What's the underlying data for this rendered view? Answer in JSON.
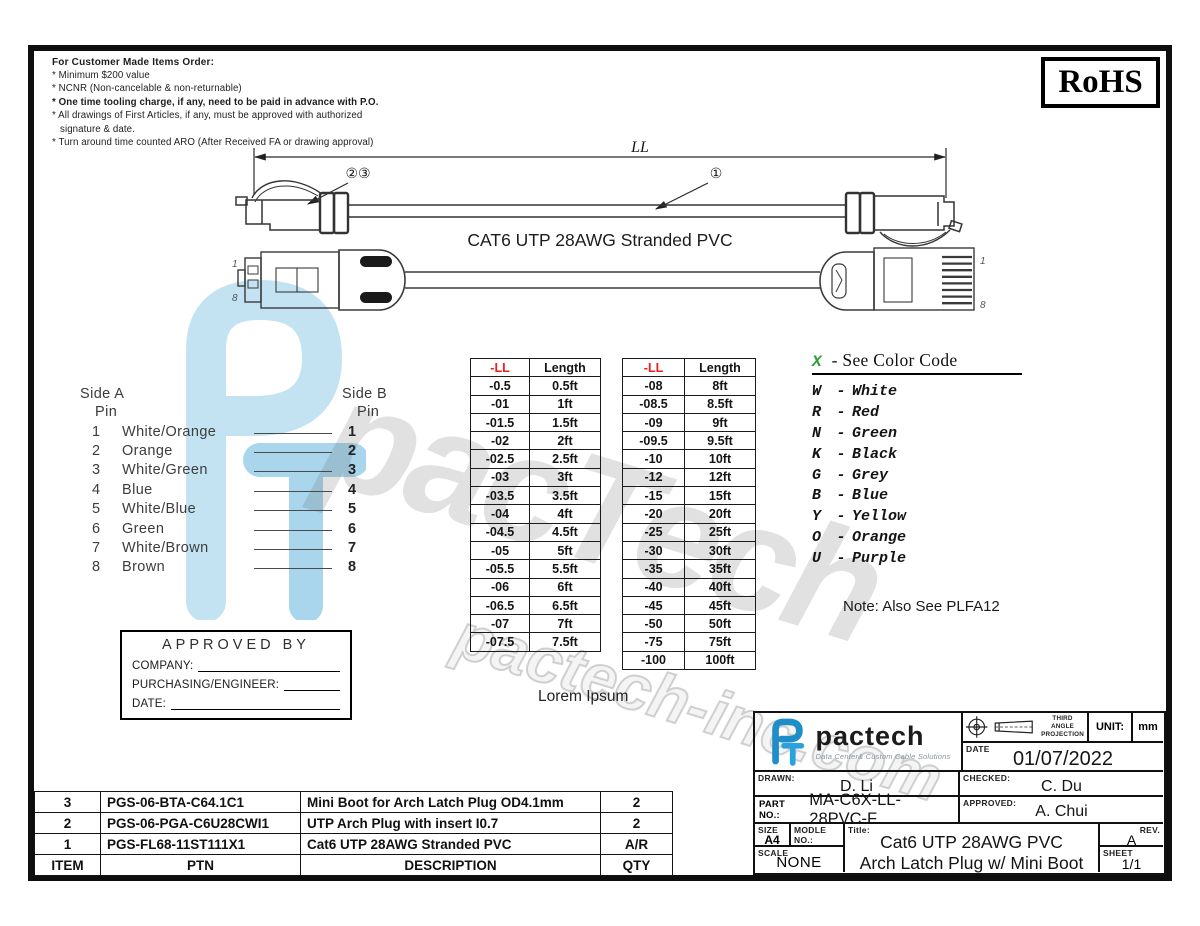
{
  "colors": {
    "accent_blue": "#2094d4",
    "red": "#e8201f",
    "green": "#2e9e3a"
  },
  "notes": {
    "title": "For Customer Made Items Order:",
    "lines": [
      "* Minimum $200 value",
      "* NCNR (Non-cancelable & non-returnable)",
      "* One time tooling charge, if any, need to be paid in advance with P.O.",
      "* All drawings of First Articles, if any, must be approved with authorized signature & date.",
      "* Turn around time counted ARO (After Received FA or drawing approval)"
    ]
  },
  "rohs_label": "RoHS",
  "drawing": {
    "dim_label": "LL",
    "callout_left": "②③",
    "callout_right": "①",
    "cable_label": "CAT6 UTP 28AWG Stranded PVC",
    "pin_first": "1",
    "pin_last": "8"
  },
  "wiring": {
    "side_a_title": "Side  A",
    "side_b_title": "Side  B",
    "pin_label": "Pin",
    "rows": [
      {
        "a": "1",
        "color": "White/Orange",
        "b": "1"
      },
      {
        "a": "2",
        "color": "Orange",
        "b": "2"
      },
      {
        "a": "3",
        "color": "White/Green",
        "b": "3"
      },
      {
        "a": "4",
        "color": "Blue",
        "b": "4"
      },
      {
        "a": "5",
        "color": "White/Blue",
        "b": "5"
      },
      {
        "a": "6",
        "color": "Green",
        "b": "6"
      },
      {
        "a": "7",
        "color": "White/Brown",
        "b": "7"
      },
      {
        "a": "8",
        "color": "Brown",
        "b": "8"
      }
    ]
  },
  "length_tables": [
    {
      "headers": [
        "-LL",
        "Length"
      ],
      "rows": [
        [
          "-0.5",
          "0.5ft"
        ],
        [
          "-01",
          "1ft"
        ],
        [
          "-01.5",
          "1.5ft"
        ],
        [
          "-02",
          "2ft"
        ],
        [
          "-02.5",
          "2.5ft"
        ],
        [
          "-03",
          "3ft"
        ],
        [
          "-03.5",
          "3.5ft"
        ],
        [
          "-04",
          "4ft"
        ],
        [
          "-04.5",
          "4.5ft"
        ],
        [
          "-05",
          "5ft"
        ],
        [
          "-05.5",
          "5.5ft"
        ],
        [
          "-06",
          "6ft"
        ],
        [
          "-06.5",
          "6.5ft"
        ],
        [
          "-07",
          "7ft"
        ],
        [
          "-07.5",
          "7.5ft"
        ]
      ]
    },
    {
      "headers": [
        "-LL",
        "Length"
      ],
      "rows": [
        [
          "-08",
          "8ft"
        ],
        [
          "-08.5",
          "8.5ft"
        ],
        [
          "-09",
          "9ft"
        ],
        [
          "-09.5",
          "9.5ft"
        ],
        [
          "-10",
          "10ft"
        ],
        [
          "-12",
          "12ft"
        ],
        [
          "-15",
          "15ft"
        ],
        [
          "-20",
          "20ft"
        ],
        [
          "-25",
          "25ft"
        ],
        [
          "-30",
          "30ft"
        ],
        [
          "-35",
          "35ft"
        ],
        [
          "-40",
          "40ft"
        ],
        [
          "-45",
          "45ft"
        ],
        [
          "-50",
          "50ft"
        ],
        [
          "-75",
          "75ft"
        ],
        [
          "-100",
          "100ft"
        ]
      ]
    }
  ],
  "color_code": {
    "header_x": "X",
    "header_rest": "-  See Color Code",
    "dash": "-",
    "entries": [
      {
        "letter": "W",
        "name": "White"
      },
      {
        "letter": "R",
        "name": "Red"
      },
      {
        "letter": "N",
        "name": "Green"
      },
      {
        "letter": "K",
        "name": "Black"
      },
      {
        "letter": "G",
        "name": "Grey"
      },
      {
        "letter": "B",
        "name": "Blue"
      },
      {
        "letter": "Y",
        "name": "Yellow"
      },
      {
        "letter": "O",
        "name": "Orange"
      },
      {
        "letter": "U",
        "name": "Purple"
      }
    ],
    "note": "Note: Also See PLFA12"
  },
  "approved_box": {
    "title": "APPROVED  BY",
    "fields": [
      "COMPANY:",
      "PURCHASING/ENGINEER:",
      "DATE:"
    ]
  },
  "lorem": "Lorem Ipsum",
  "bom": {
    "headers": [
      "ITEM",
      "PTN",
      "DESCRIPTION",
      "QTY"
    ],
    "rows": [
      [
        "3",
        "PGS-06-BTA-C64.1C1",
        "Mini Boot for Arch Latch Plug OD4.1mm",
        "2"
      ],
      [
        "2",
        "PGS-06-PGA-C6U28CWI1",
        "UTP Arch Plug with insert I0.7",
        "2"
      ],
      [
        "1",
        "PGS-FL68-11ST111X1",
        "Cat6 UTP 28AWG Stranded PVC",
        "A/R"
      ]
    ]
  },
  "title_block": {
    "brand": "pactech",
    "tagline": "Data Center& Custom Cable Solutions",
    "projection": "THIRD\nANGLE\nPROJECTION",
    "unit_label": "UNIT:",
    "unit_value": "mm",
    "date_label": "DATE",
    "date_value": "01/07/2022",
    "drawn_label": "DRAWN:",
    "drawn_value": "D. Li",
    "checked_label": "CHECKED:",
    "checked_value": "C. Du",
    "part_no_label": "PART NO.:",
    "part_no_value": "MA-C6X-LL-28PVC-F",
    "approved_label": "APPROVED:",
    "approved_value": "A. Chui",
    "size_label": "SIZE",
    "size_value": "A4",
    "module_label": "MODLE NO.:",
    "title_label": "Title:",
    "title_line1": "Cat6 UTP 28AWG PVC",
    "title_line2": "Arch Latch Plug w/ Mini Boot",
    "scale_label": "SCALE",
    "scale_value": "NONE",
    "rev_label": "REV.",
    "rev_value": "A",
    "sheet_label": "SHEET",
    "sheet_value": "1/1"
  },
  "watermark": {
    "big_text": "pacTech",
    "small_text": "pactech-inc.com"
  }
}
